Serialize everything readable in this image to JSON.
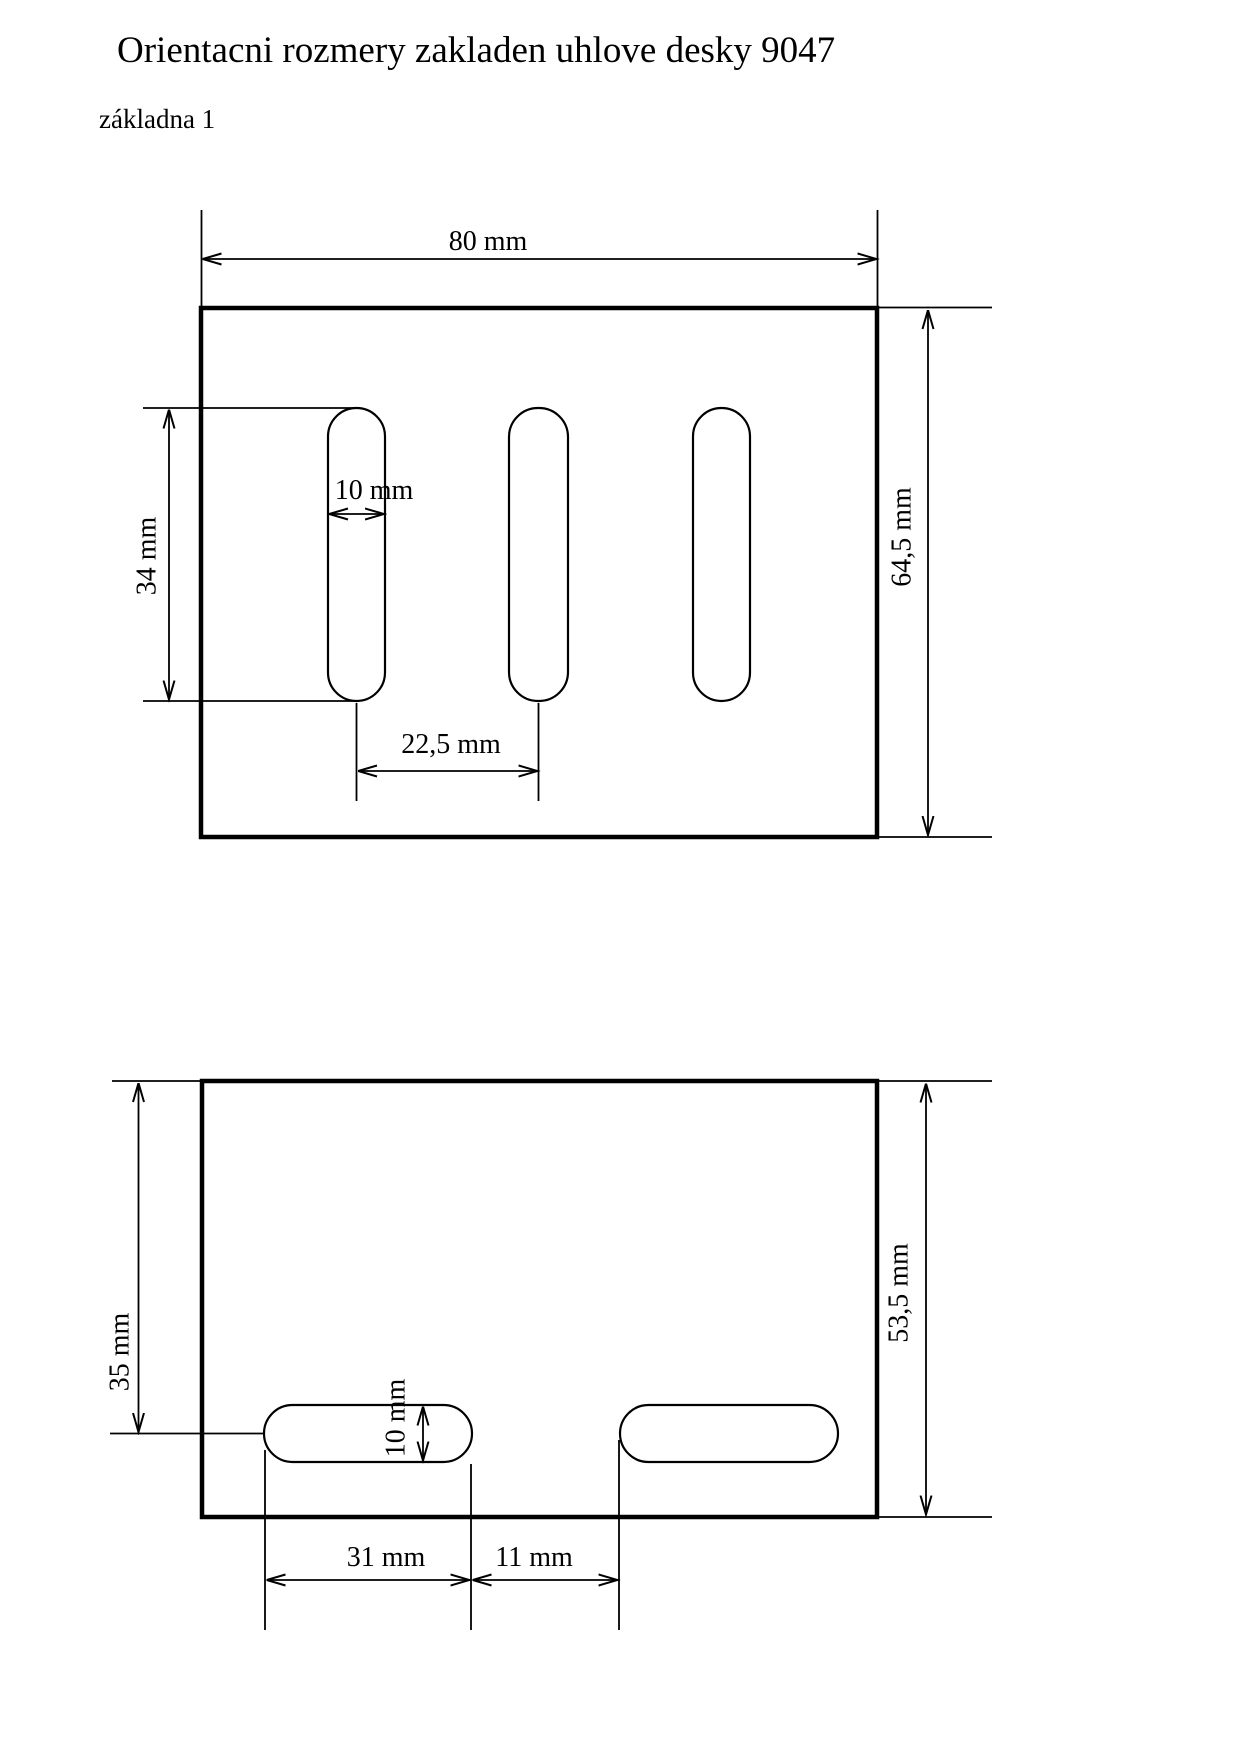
{
  "title": "Orientacni rozmery zakladen uhlove desky 9047",
  "subtitle": "základna 1",
  "top_view": {
    "width_label": "80 mm",
    "height_label": "64,5 mm",
    "slot_length_label": "34 mm",
    "slot_width_label": "10 mm",
    "slot_spacing_label": "22,5 mm"
  },
  "bottom_view": {
    "edge_to_slot_label": "35 mm",
    "height_label": "53,5 mm",
    "slot_height_label": "10 mm",
    "slot_length_label": "31 mm",
    "slot_gap_label": "11 mm"
  }
}
